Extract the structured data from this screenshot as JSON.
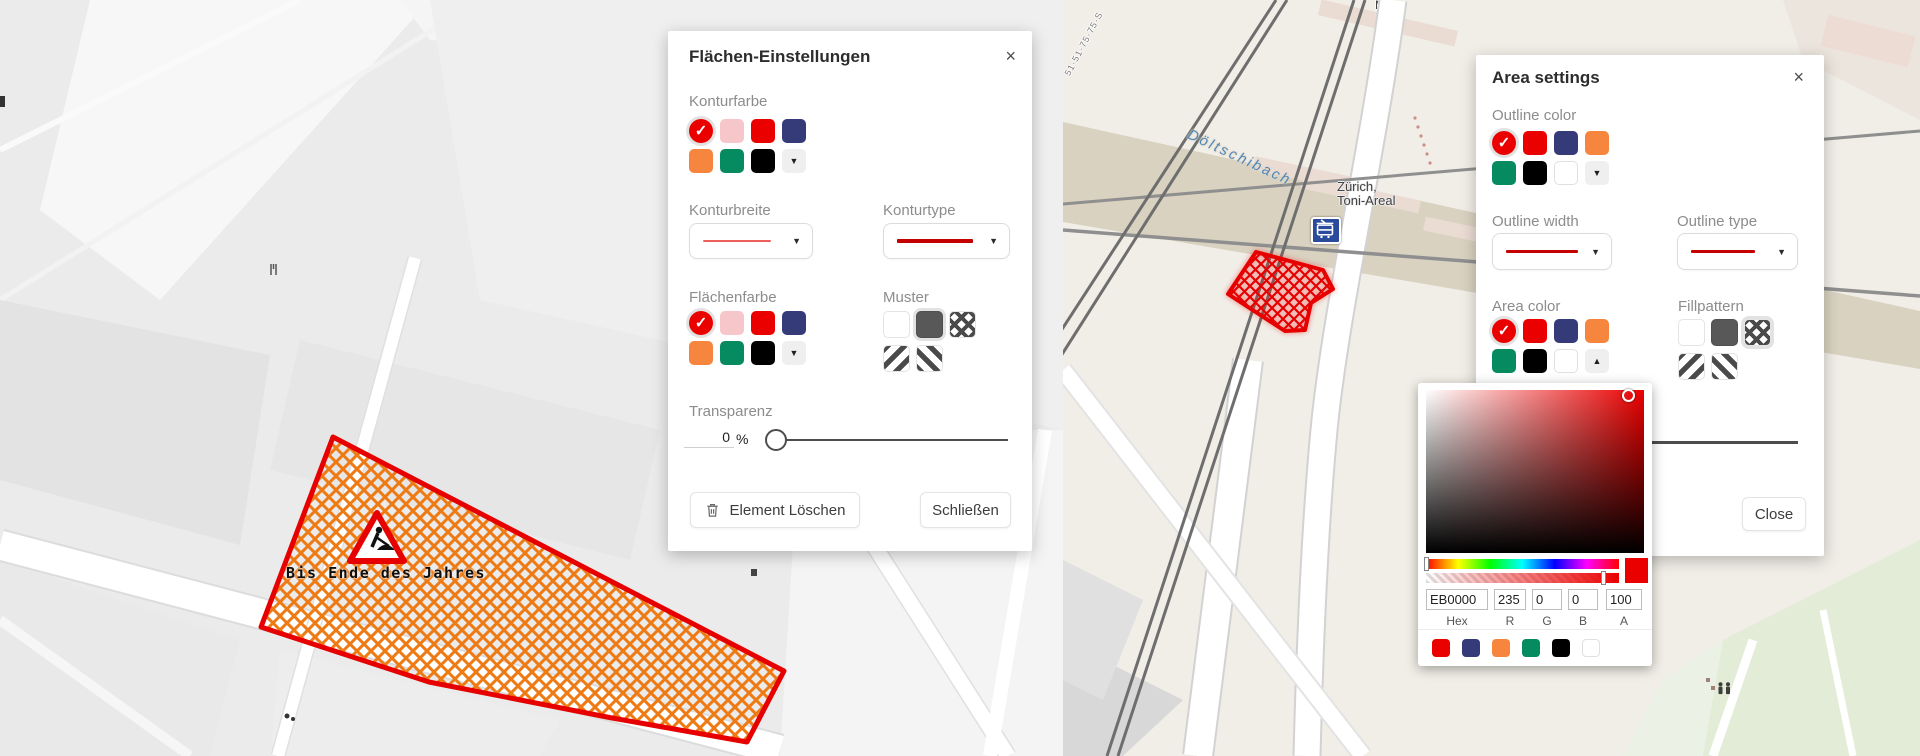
{
  "flaechen_dialog": {
    "title": "Flächen-Einstellungen",
    "close_glyph": "×",
    "konturfarbe_label": "Konturfarbe",
    "konturbreite_label": "Konturbreite",
    "konturtype_label": "Konturtype",
    "flaechenfarbe_label": "Flächenfarbe",
    "muster_label": "Muster",
    "transparenz_label": "Transparenz",
    "transparenz_value": "0",
    "transparenz_unit": "%",
    "delete_button": "Element Löschen",
    "close_button": "Schließen",
    "kontur_swatches": [
      {
        "c": "#eb0000",
        "sel": true
      },
      {
        "c": "#f7c6cb"
      },
      {
        "c": "#eb0000"
      },
      {
        "c": "#353a78"
      },
      {
        "c": "#f6863e"
      },
      {
        "c": "#068a5f"
      },
      {
        "c": "#000000"
      },
      {
        "t": "caret-down"
      }
    ],
    "flaechen_swatches": [
      {
        "c": "#eb0000",
        "sel": true
      },
      {
        "c": "#f7c6cb"
      },
      {
        "c": "#eb0000"
      },
      {
        "c": "#353a78"
      },
      {
        "c": "#f6863e"
      },
      {
        "c": "#068a5f"
      },
      {
        "c": "#000000"
      },
      {
        "t": "caret-down"
      }
    ],
    "muster_swatches": [
      {
        "p": "none"
      },
      {
        "p": "solid",
        "sel": true
      },
      {
        "p": "cross"
      },
      {
        "p": "diag1"
      },
      {
        "p": "diag2"
      }
    ]
  },
  "area_dialog": {
    "title": "Area settings",
    "close_glyph": "×",
    "outline_color_label": "Outline color",
    "outline_width_label": "Outline width",
    "outline_type_label": "Outline type",
    "area_color_label": "Area color",
    "fillpattern_label": "Fillpattern",
    "close_button": "Close",
    "outline_swatches": [
      {
        "c": "#eb0000",
        "sel": true
      },
      {
        "c": "#eb0000"
      },
      {
        "c": "#353a78"
      },
      {
        "c": "#f6863e"
      },
      {
        "c": "#068a5f"
      },
      {
        "c": "#000000"
      },
      {
        "c": "#ffffff"
      },
      {
        "t": "caret-down"
      }
    ],
    "area_swatches": [
      {
        "c": "#eb0000",
        "sel": true
      },
      {
        "c": "#eb0000"
      },
      {
        "c": "#353a78"
      },
      {
        "c": "#f6863e"
      },
      {
        "c": "#068a5f"
      },
      {
        "c": "#000000"
      },
      {
        "c": "#ffffff"
      },
      {
        "t": "caret-up"
      }
    ],
    "fill_swatches": [
      {
        "p": "none"
      },
      {
        "p": "solid"
      },
      {
        "p": "cross",
        "sel": true
      },
      {
        "p": "diag1"
      },
      {
        "p": "diag2"
      }
    ]
  },
  "color_picker": {
    "hex_value": "EB0000",
    "r_value": "235",
    "g_value": "0",
    "b_value": "0",
    "a_value": "100",
    "hex_label": "Hex",
    "r_label": "R",
    "g_label": "G",
    "b_label": "B",
    "a_label": "A",
    "presets": [
      {
        "c": "#eb0000"
      },
      {
        "c": "#353a78"
      },
      {
        "c": "#f6863e"
      },
      {
        "c": "#068a5f"
      },
      {
        "c": "#000000"
      },
      {
        "c": "#ffffff"
      }
    ]
  },
  "left_map": {
    "annotation_text": "Bis Ende des Jahres",
    "streets": [
      "Europaallee",
      "Europaallee",
      "Europaallee",
      "Eisgasse"
    ]
  },
  "right_map": {
    "stream_label": "Döltschibach",
    "station_label_line1": "Zürich,",
    "station_label_line2": "Toni-Areal",
    "bridge_label": "Duttweilerbrücke",
    "park_label": "Pfingstweid",
    "partial_label_top": "Mü",
    "rail_route_label": "51·51·75·75·S"
  },
  "colors": {
    "accent_red": "#eb0000",
    "outline_red": "#e60000",
    "navy": "#353a78",
    "orange": "#f6863e",
    "green": "#068a5f",
    "pink": "#f7c6cb",
    "hatch_orange": "#ee7a14"
  }
}
